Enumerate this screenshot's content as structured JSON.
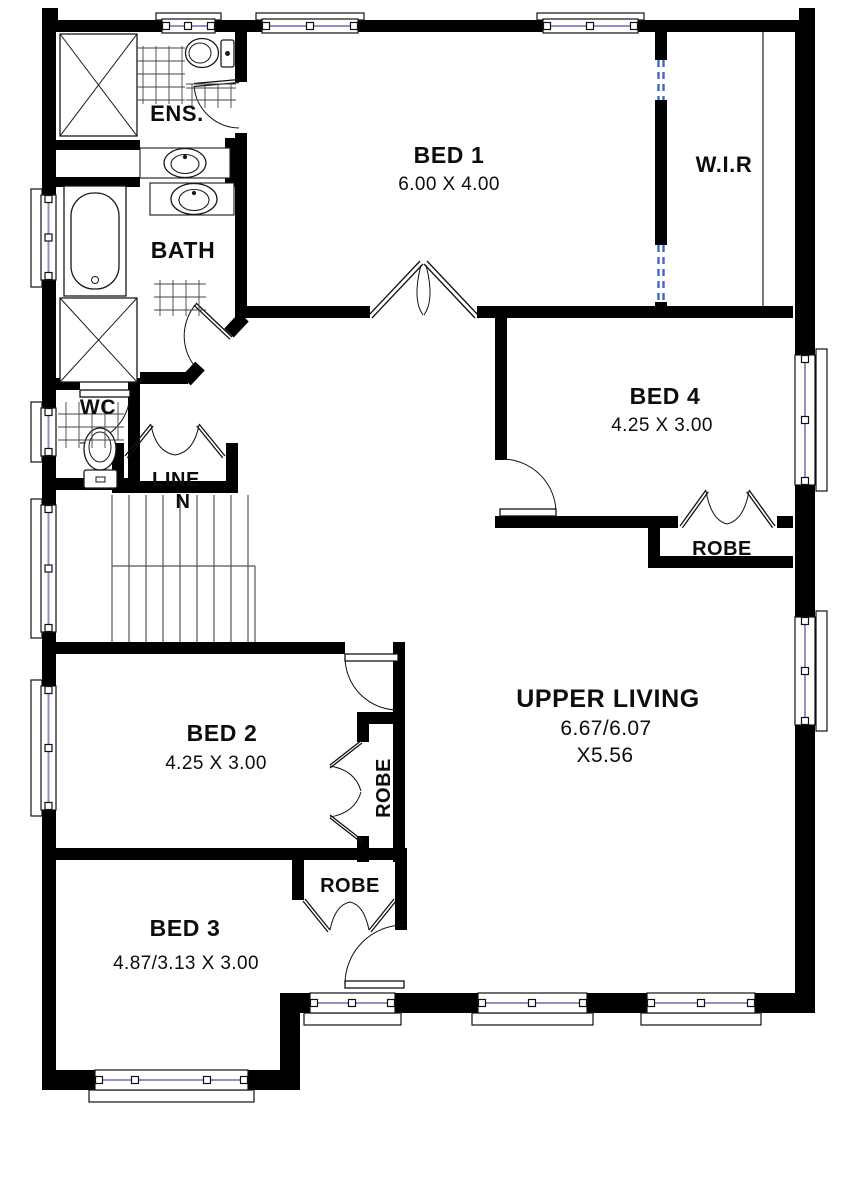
{
  "rooms": {
    "bed1": {
      "name": "BED 1",
      "dims": "6.00 X 4.00"
    },
    "bed2": {
      "name": "BED 2",
      "dims": "4.25 X 3.00"
    },
    "bed3": {
      "name": "BED 3",
      "dims": "4.87/3.13 X 3.00"
    },
    "bed4": {
      "name": "BED 4",
      "dims": "4.25 X 3.00"
    },
    "upper_living": {
      "name": "UPPER LIVING",
      "dims1": "6.67/6.07",
      "dims2": "X5.56"
    },
    "wir": {
      "name": "W.I.R"
    },
    "ens": {
      "name": "ENS."
    },
    "bath": {
      "name": "BATH"
    },
    "wc": {
      "name": "WC"
    },
    "linen": {
      "name_line1": "LINE",
      "name_line2": "N"
    }
  },
  "closets": {
    "bed4_robe": "ROBE",
    "bed2_robe": "ROBE",
    "bed3_robe": "ROBE"
  },
  "colors": {
    "wall": "#000000",
    "background": "#ffffff",
    "glazing": "#8e93c4",
    "opening_dashed": "#4468c8",
    "fixture_line": "#1a1a1a"
  }
}
